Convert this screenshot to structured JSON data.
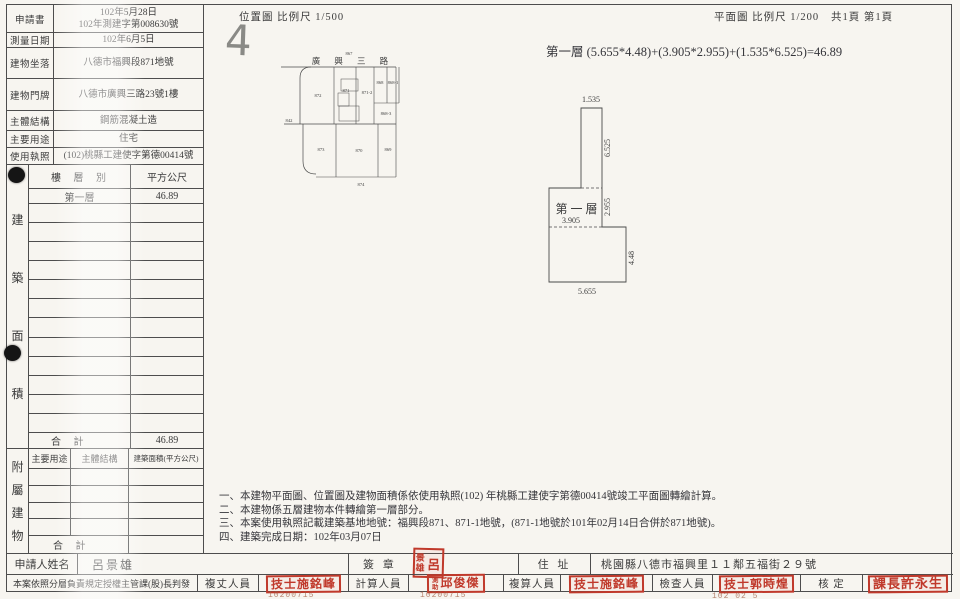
{
  "colors": {
    "stamp_red": "#c0392b",
    "paper": "#f7f5f0",
    "ink": "#3b3b3b"
  },
  "header": {
    "location_map_scale": "位置圖 比例尺  1/500",
    "floor_plan_scale": "平面圖 比例尺  1/200",
    "page_count": "共1頁 第1頁",
    "handwritten_mark": "4"
  },
  "info_table": {
    "rows": [
      {
        "label": "申請書",
        "value": "102年5月28日\n102年測建字第008630號"
      },
      {
        "label": "測量日期",
        "value": "102年6月5日"
      },
      {
        "label": "建物坐落",
        "value": "八德市福興段871地號"
      },
      {
        "label": "建物門牌",
        "value": "八德市廣興三路23號1樓"
      },
      {
        "label": "主體結構",
        "value": "鋼筋混凝土造"
      },
      {
        "label": "主要用途",
        "value": "住宅"
      },
      {
        "label": "使用執照",
        "value": "(102)桃縣工建使字第德00414號"
      }
    ]
  },
  "building_area": {
    "side_label": "建築面積",
    "col_floor": "樓 層 別",
    "col_area": "平方公尺",
    "rows": [
      {
        "floor": "第一層",
        "area": "46.89"
      }
    ],
    "empty_row_count": 12,
    "total_label": "合  計",
    "total_value": "46.89"
  },
  "annex": {
    "side_label": "附屬建物",
    "col_use": "主要用途",
    "col_structure": "主體結構",
    "col_area": "建築面積(平方公尺)",
    "empty_row_count": 4,
    "total_label": "合  計"
  },
  "applicant": {
    "name_label": "申請人姓名",
    "name": "呂景雄",
    "seal_label": "簽 章",
    "address_label": "住 址",
    "address": "桃園縣八德市福興里１１鄰五福街２９號"
  },
  "approval": {
    "authorization": "本案依照分層負責規定授權主管課(股)長判發",
    "officers": [
      {
        "role": "複丈人員",
        "stamp": "技士施銘峰",
        "date": "10200715"
      },
      {
        "role": "計算人員",
        "stamp_prefix": "測助",
        "stamp": "邱俊傑",
        "date": "10200715"
      },
      {
        "role": "複算人員",
        "stamp": "技士施銘峰",
        "date": ""
      },
      {
        "role": "檢查人員",
        "stamp": "技士郭時煌",
        "date": "102 02 5"
      },
      {
        "role": "核  定",
        "stamp": "課長許永生",
        "date": ""
      }
    ]
  },
  "floor_plan": {
    "formula": "第一層 (5.655*4.48)+(3.905*2.955)+(1.535*6.525)=46.89",
    "room_label": "第一層",
    "dims": {
      "top_width": "1.535",
      "upper_right_height": "6.525",
      "mid_right_height": "2.955",
      "mid_width": "3.905",
      "lower_right_height": "4.48",
      "bottom_width": "5.655"
    }
  },
  "location_plan": {
    "street": "廣 興 三 路",
    "street_parcel": "867",
    "parcels": {
      "p872": "872",
      "p871": "871",
      "p871_2": "871-2",
      "p868": "868",
      "p868_1": "868-1",
      "p868_3": "868-3",
      "p873": "873",
      "p870": "870",
      "p869": "869",
      "p874": "874",
      "p842": "842"
    }
  },
  "notes": {
    "line1": "一、本建物平面圖、位置圖及建物面積係依使用執照(102) 年桃縣工建使字第德00414號竣工平面圖轉繪計算。",
    "line2": "二、本建物係五層建物本件轉繪第一層部分。",
    "line3": "三、本案使用執照記載建築基地地號：福興段871、871-1地號，(871-1地號於101年02月14日合併於871地號)。",
    "line4": "四、建築完成日期：102年03月07日"
  }
}
